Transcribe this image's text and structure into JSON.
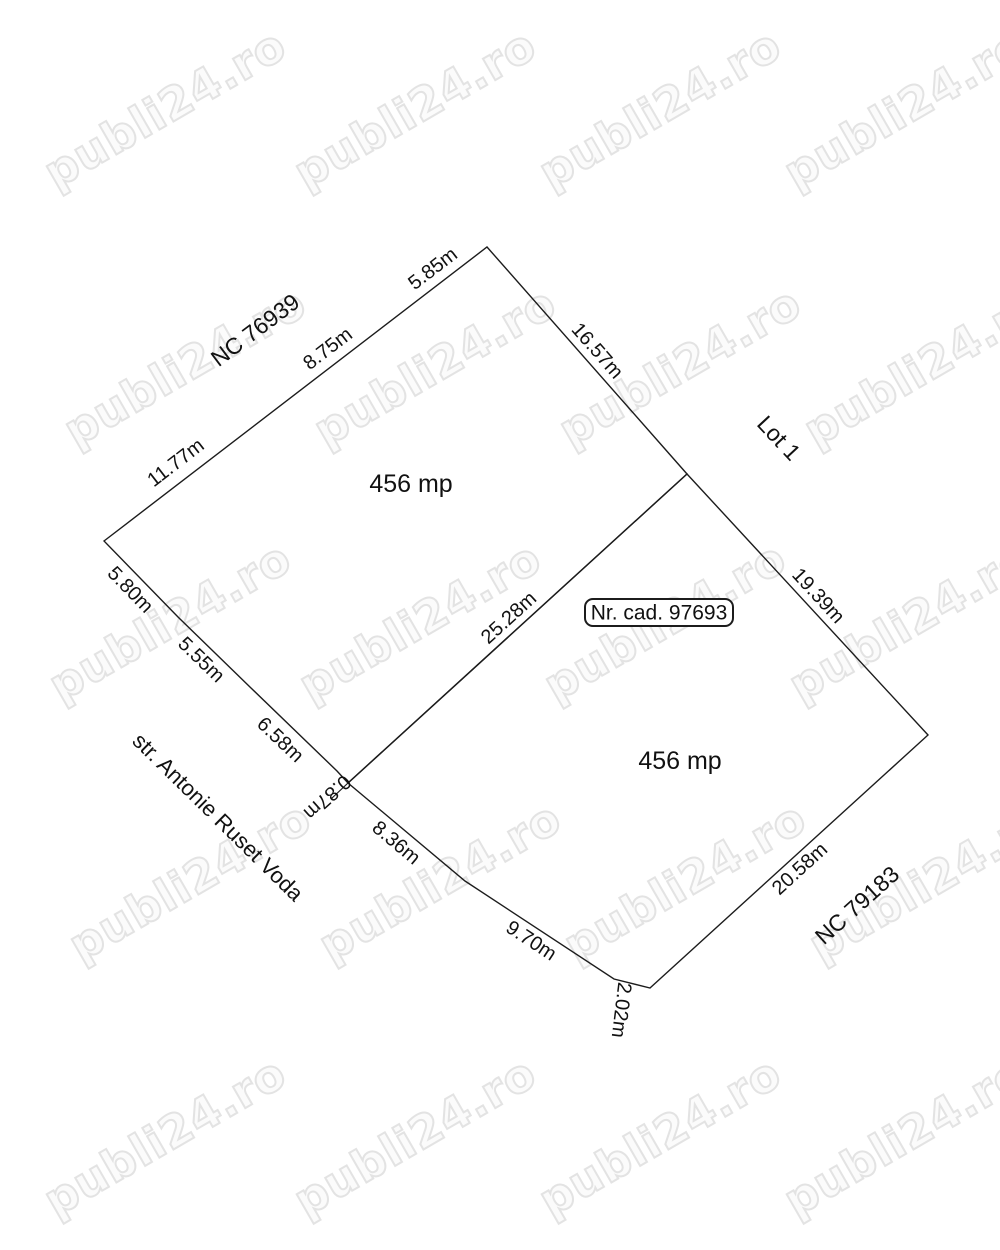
{
  "watermark": {
    "text": "publi24.ro"
  },
  "plan": {
    "cadastral_label": "Nr. cad. 97693",
    "street_label": "str. Antonie Ruset Voda",
    "neighbors": {
      "northwest": "NC 76939",
      "east": "Lot 1",
      "southeast": "NC 79183"
    },
    "parcels": [
      {
        "name": "upper parcel",
        "area_label": "456 mp"
      },
      {
        "name": "lower parcel",
        "area_label": "456 mp"
      }
    ],
    "edges": [
      {
        "side": "northwest",
        "text": "5.85m"
      },
      {
        "side": "northwest",
        "text": "8.75m"
      },
      {
        "side": "northwest",
        "text": "11.77m"
      },
      {
        "side": "northeast",
        "text": "16.57m"
      },
      {
        "side": "east",
        "text": "19.39m"
      },
      {
        "side": "divider",
        "text": "25.28m"
      },
      {
        "side": "street",
        "text": "5.80m"
      },
      {
        "side": "street",
        "text": "5.55m"
      },
      {
        "side": "street",
        "text": "6.58m"
      },
      {
        "side": "street",
        "text": "0.87m"
      },
      {
        "side": "street",
        "text": "8.36m"
      },
      {
        "side": "street",
        "text": "9.70m"
      },
      {
        "side": "street",
        "text": "2.02m"
      },
      {
        "side": "southeast",
        "text": "20.58m"
      }
    ],
    "colors": {
      "line": "#1c1c1c",
      "watermark_outline": "#e3e3e3",
      "background": "#ffffff"
    }
  }
}
